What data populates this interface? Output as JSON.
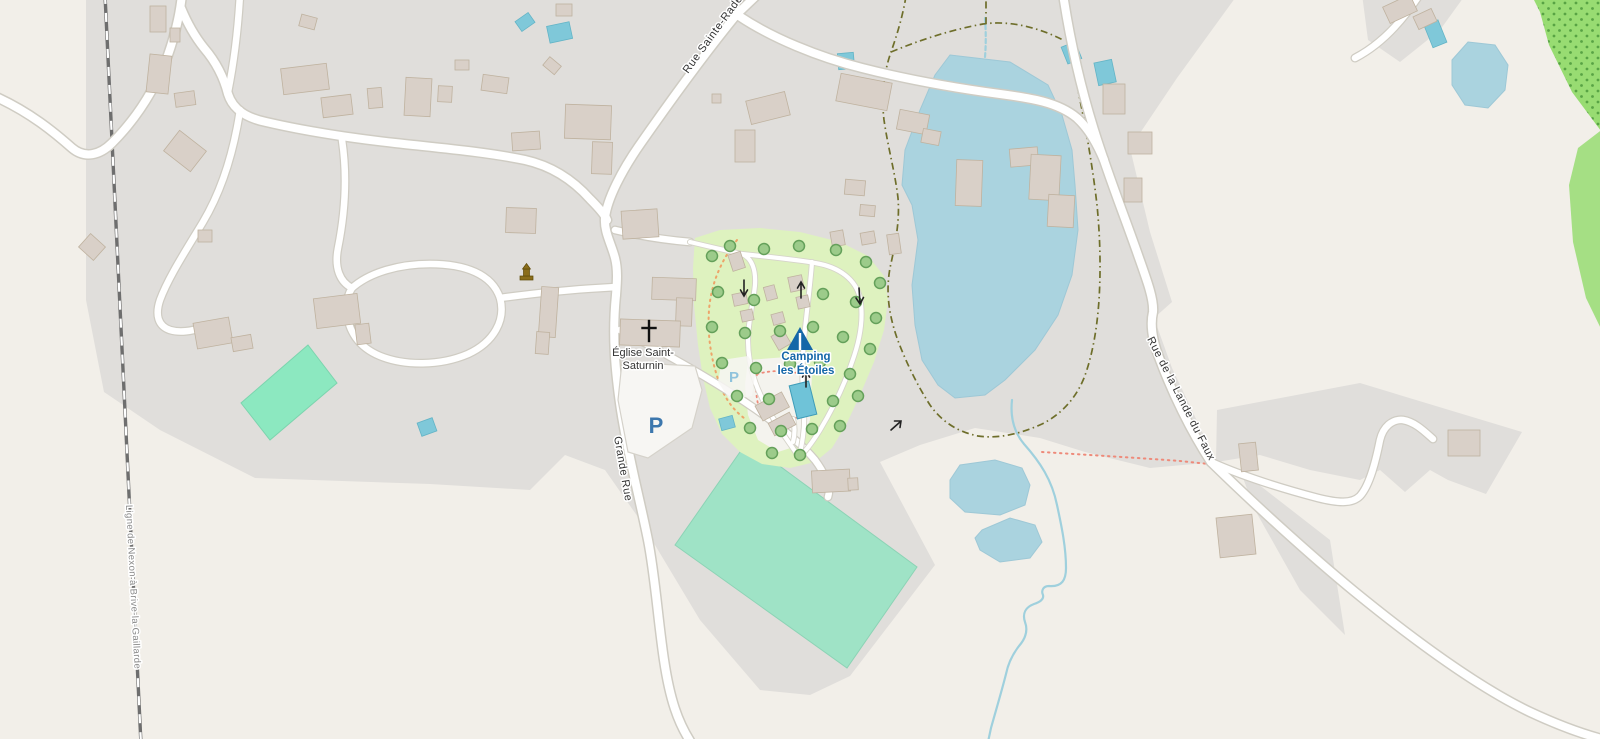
{
  "map": {
    "title": "Village map with campsite, church, lake and railway",
    "labels": {
      "railway_line": "Ligne de Nexon à Brive-la-Gaillarde",
      "street_main_north": "Rue Sainte-Rade",
      "street_grande_rue": "Grande Rue",
      "street_lande_du_faux": "Rue de la Lande du Faux",
      "church_line1": "Église Saint-",
      "church_line2": "Saturnin",
      "camping_line1": "Camping",
      "camping_line2": "les Étoiles",
      "parking_letter_main": "P",
      "parking_letter_camping": "P"
    },
    "icons": {
      "church": "christian-cross-icon",
      "campsite": "tent-icon",
      "monument": "monument-icon",
      "oneway": "oneway-arrow-icon",
      "tree": "tree-icon",
      "parking": "parking-icon"
    },
    "colors": {
      "background": "#f2efe9",
      "residential": "#e0dedb",
      "road_fill": "#ffffff",
      "road_casing": "#cfccc3",
      "lane_casing": "#d6d4ca",
      "building_fill": "#d9d0c8",
      "building_stroke": "#bfb29f",
      "water": "#aad3df",
      "water_stroke": "#9ec8d6",
      "pond": "#7fc8d9",
      "pool": "#6fc3d8",
      "pitch": "#9fe3c6",
      "pitch_bright": "#8ce8c0",
      "camp": "#def2bf",
      "camp_service": "#f4f3ee",
      "orchard": "#98dc72",
      "orchard_dot": "#58a344",
      "tree_fill": "#9ccb8a",
      "tree_stroke": "#64a05a",
      "rail": "#6e6e6e",
      "path_olive": "#6e6e2a",
      "path_salmon": "#ee8a7a",
      "path_orange": "#eda469",
      "label": "#333333",
      "railway_label": "#8a8a8a",
      "poi_blue": "#1467a8",
      "parking_blue": "#3c77ad",
      "parking_light": "#8fc3dc",
      "stream": "#9fd0dd",
      "monument_gold": "#8a6d1a",
      "parking_area": "#f7f6f3",
      "parking_area_border": "#d5d2ca"
    }
  }
}
